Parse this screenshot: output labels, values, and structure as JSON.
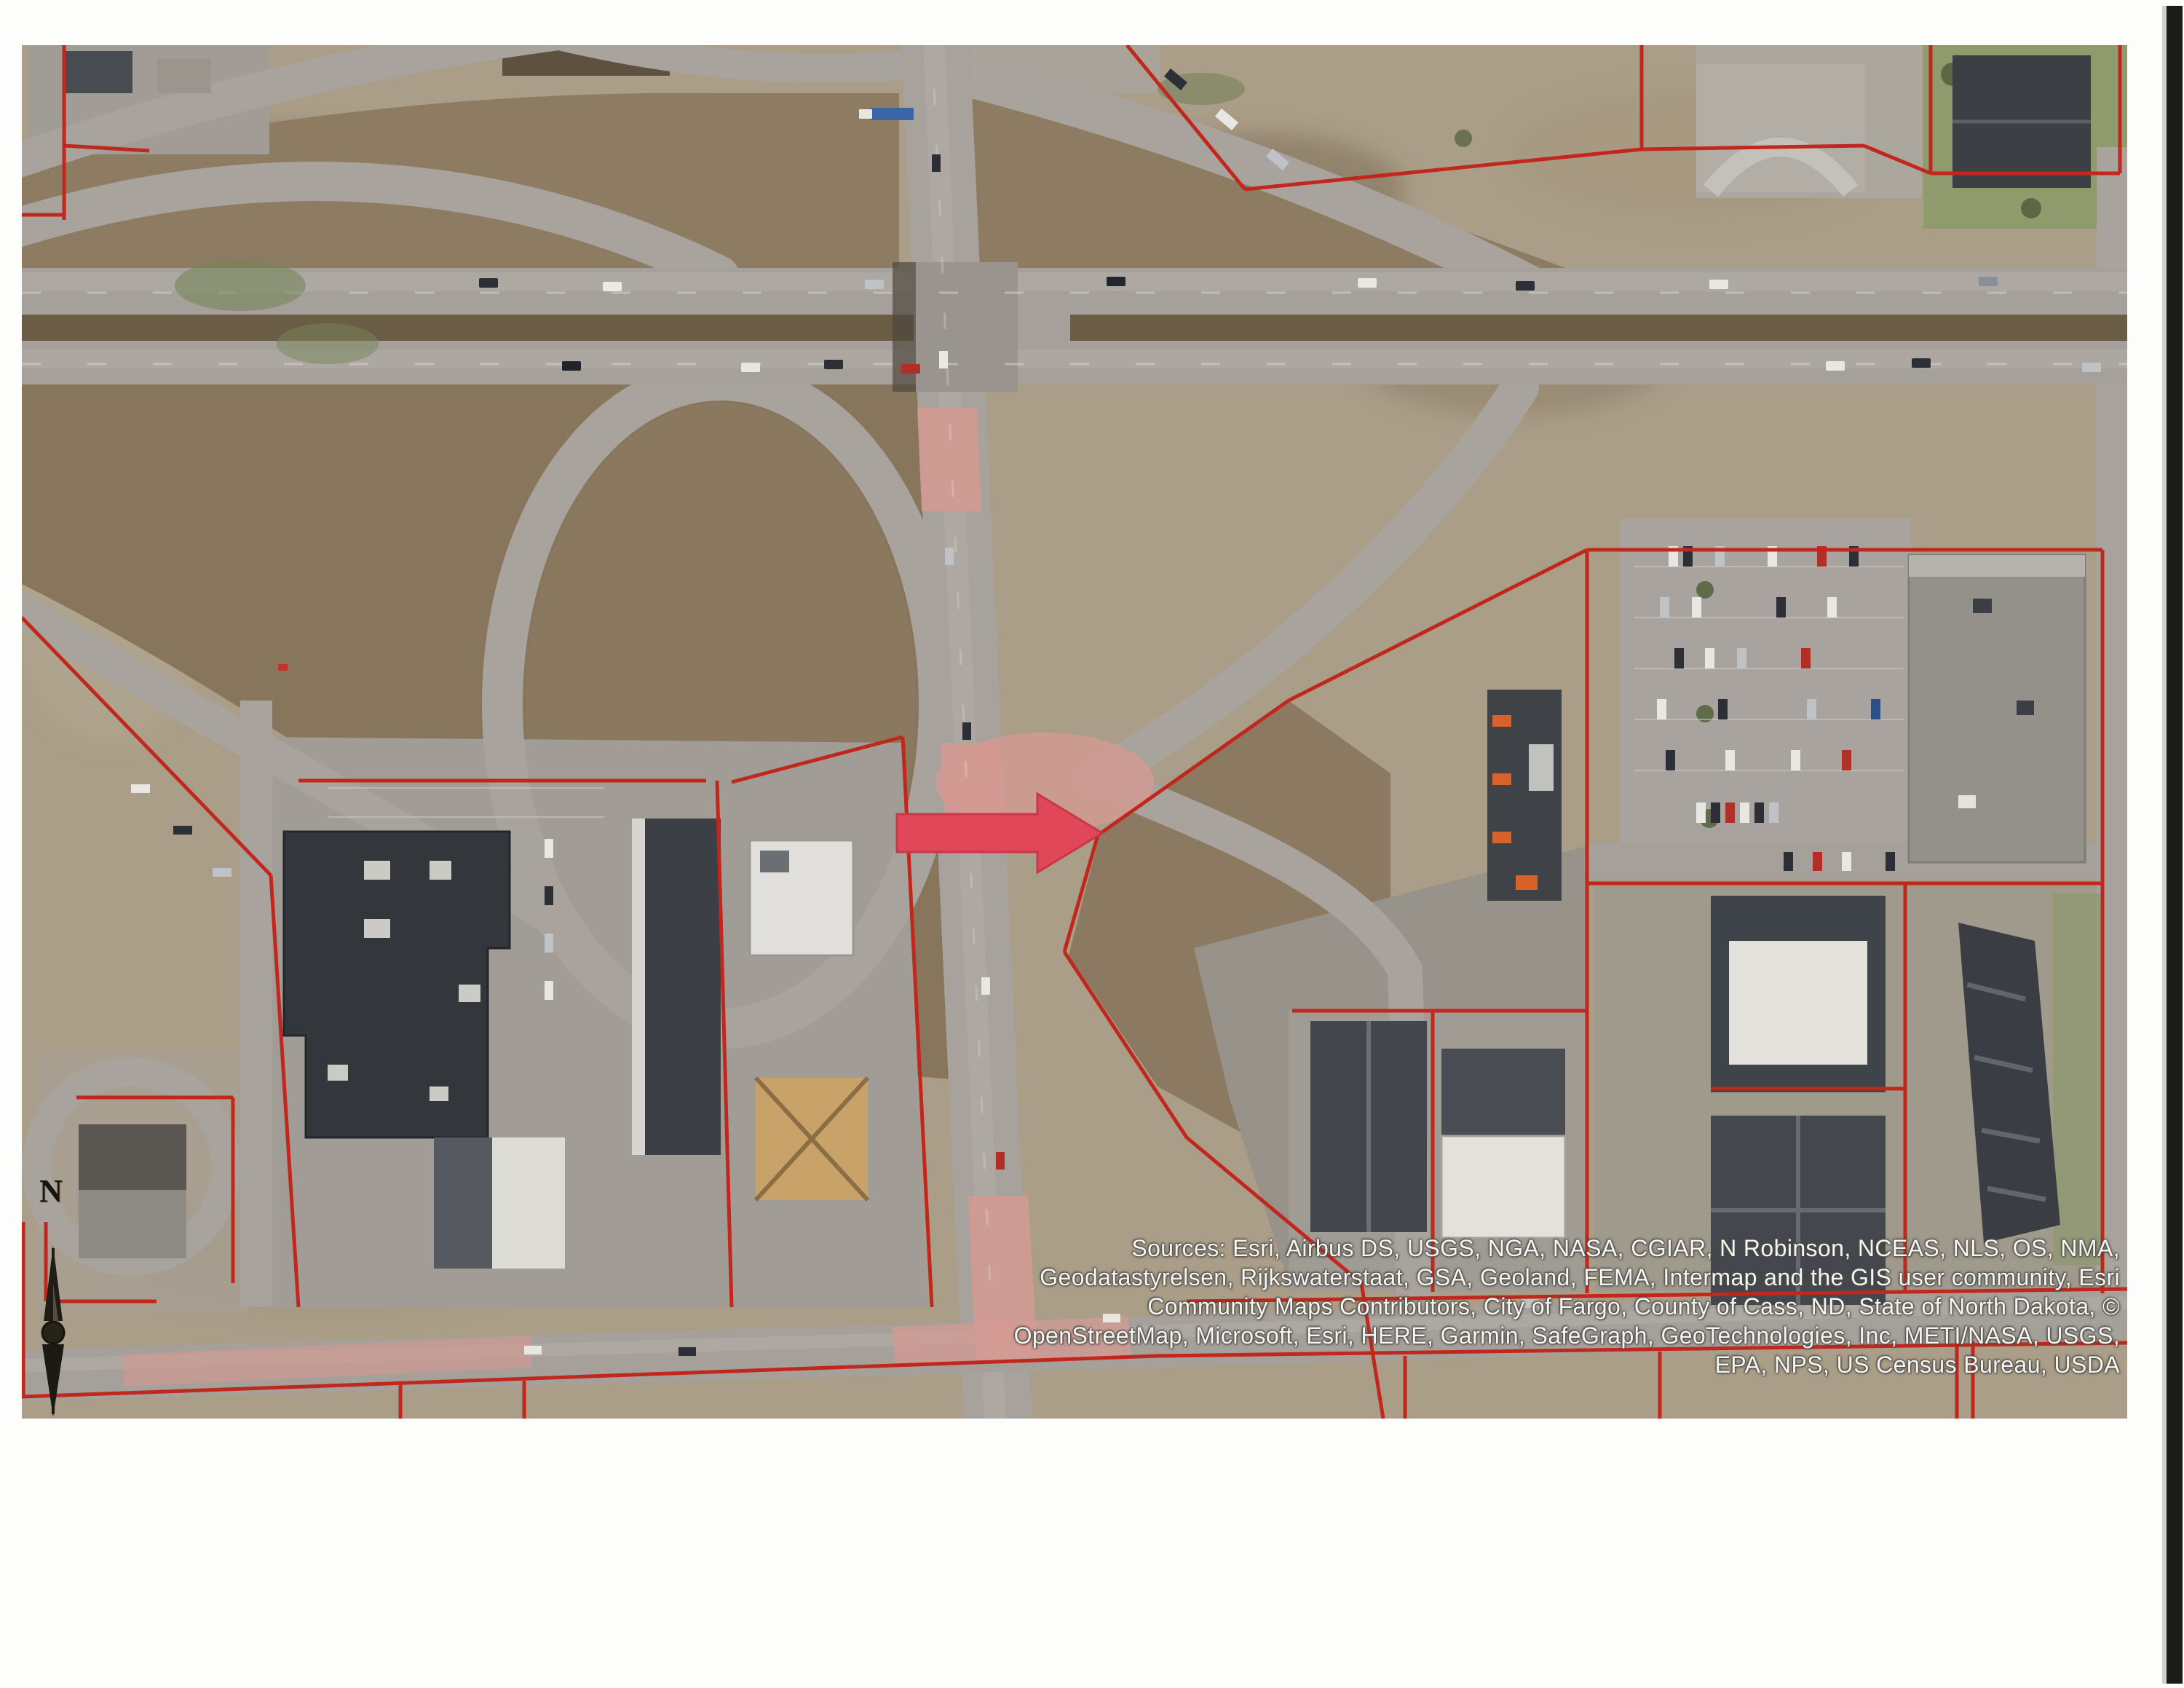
{
  "page": {
    "description": "Scanned aerial parcel map page, freeway interchange with commercial lots",
    "region": "City of Fargo, County of Cass, ND"
  },
  "map": {
    "attribution": {
      "line1": "Sources: Esri, Airbus DS, USGS, NGA, NASA, CGIAR, N Robinson, NCEAS, NLS, OS, NMA,",
      "line2": "Geodatastyrelsen, Rijkswaterstaat, GSA, Geoland, FEMA, Intermap and the GIS user community, Esri",
      "line3": "Community Maps Contributors, City of Fargo, County of Cass, ND, State of North Dakota, ©",
      "line4": "OpenStreetMap, Microsoft, Esri, HERE, Garmin, SafeGraph, GeoTechnologies, Inc, METI/NASA, USGS,",
      "line5": "EPA, NPS, US Census Bureau, USDA"
    },
    "north_arrow": {
      "label": "N"
    },
    "colors": {
      "parcel_line": "#c1271c",
      "highlight_arrow": "#e0485a",
      "field_brown": "#87765c",
      "road_gray": "#a7a29c",
      "pink_pavement": "#d49a92",
      "scan_bar": "#1b1b1a"
    }
  }
}
